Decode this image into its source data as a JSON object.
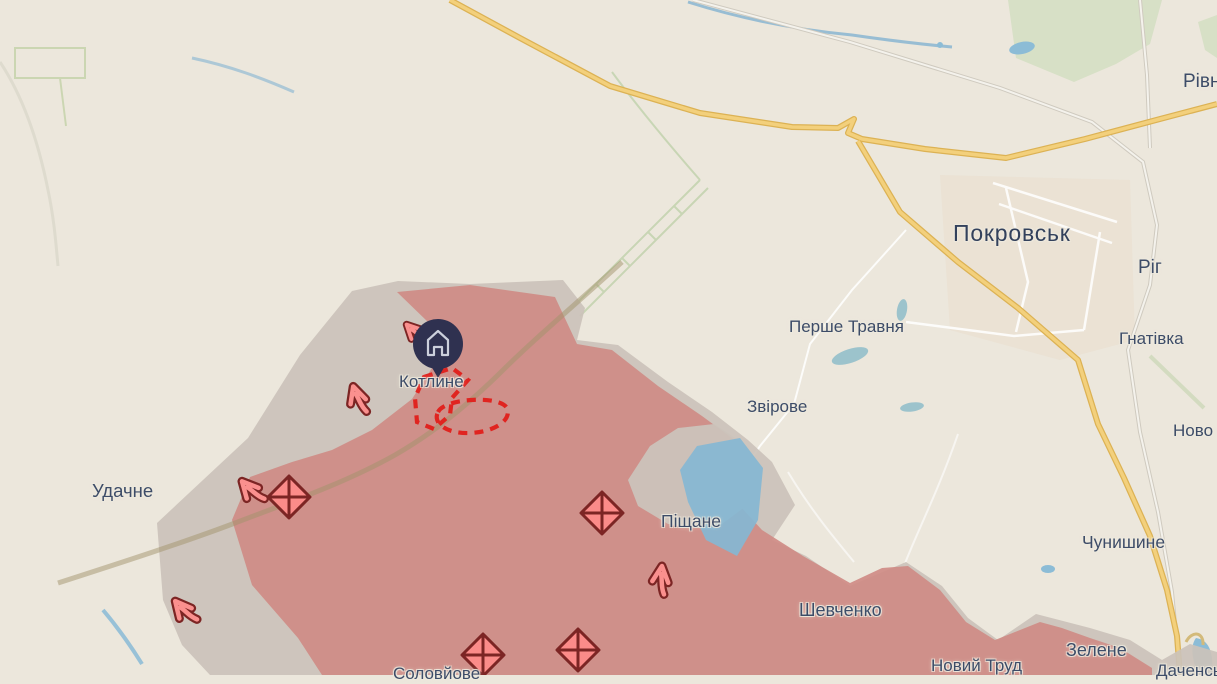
{
  "map": {
    "region_name": "Pokrovsk direction frontline map",
    "colors": {
      "background": "#ece7dc",
      "occupied_zone": "#cf9089",
      "contested_zone": "#cbc3ba",
      "water": "#8fbdd8",
      "forest": "#d7e0c6",
      "road_major": "#f3d07c",
      "road_minor": "#ffffff",
      "railway": "#cfcabf",
      "label_text": "#3d4c68",
      "assault_dash_red": "#e02420",
      "arrow_fill": "#fa908e",
      "arrow_outline": "#7c2524",
      "pin_fill": "#2f3150",
      "pin_icon": "#ccd0dc"
    },
    "labels": [
      {
        "id": "rivne",
        "text": "Рівне"
      },
      {
        "id": "pokrovsk",
        "text": "Покровськ"
      },
      {
        "id": "rih",
        "text": "Ріг"
      },
      {
        "id": "hnativka",
        "text": "Гнатівка"
      },
      {
        "id": "pershe-travnia",
        "text": "Перше Травня"
      },
      {
        "id": "zvirove",
        "text": "Звірове"
      },
      {
        "id": "novo",
        "text": "Ново"
      },
      {
        "id": "kotlyne",
        "text": "Котлине"
      },
      {
        "id": "udachne",
        "text": "Удачне"
      },
      {
        "id": "pishchane",
        "text": "Піщане"
      },
      {
        "id": "chunyshyne",
        "text": "Чунишине"
      },
      {
        "id": "shevchenko",
        "text": "Шевченко"
      },
      {
        "id": "zelene",
        "text": "Зелене"
      },
      {
        "id": "novyi-trud",
        "text": "Новий Труд"
      },
      {
        "id": "dachenske",
        "text": "Даченське"
      },
      {
        "id": "soloviove",
        "text": "Соловйове"
      }
    ],
    "pin": {
      "place": "Котлине"
    },
    "symbols": {
      "attack_arrows": 5,
      "battle_markers": 4,
      "dashed_assault_areas": 2
    }
  }
}
